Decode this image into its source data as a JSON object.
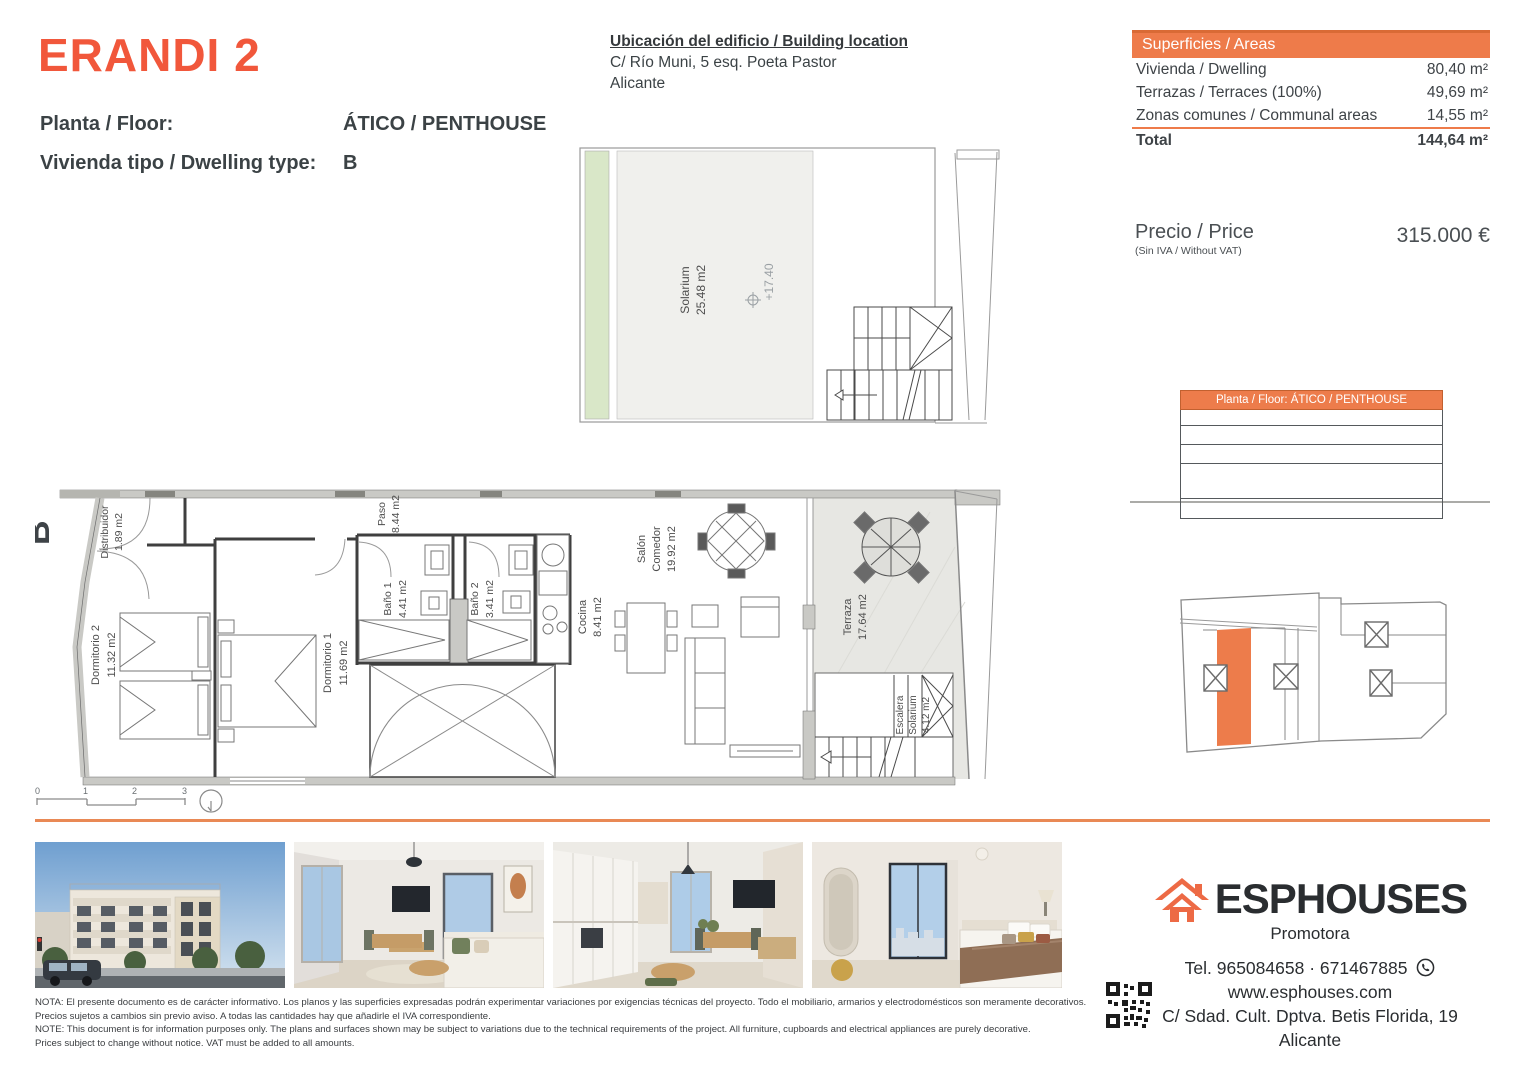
{
  "header": {
    "brand": "ERANDI 2",
    "floor_label": "Planta / Floor:",
    "floor_value": "ÁTICO / PENTHOUSE",
    "dwelling_label": "Vivienda tipo / Dwelling type:",
    "dwelling_value": "B"
  },
  "location": {
    "title": "Ubicación del edificio / Building location",
    "line1": "C/ Río Muni, 5 esq. Poeta Pastor",
    "line2": "Alicante"
  },
  "areas": {
    "title": "Superficies / Areas",
    "rows": [
      {
        "label": "Vivienda / Dwelling",
        "value": "80,40 m²"
      },
      {
        "label": "Terrazas / Terraces (100%)",
        "value": "49,69 m²"
      },
      {
        "label": "Zonas comunes / Communal areas",
        "value": "14,55 m²"
      }
    ],
    "total_label": "Total",
    "total_value": "144,64 m²"
  },
  "price": {
    "label": "Precio / Price",
    "note": "(Sin IVA / Without VAT)",
    "value": "315.000 €"
  },
  "key_plan": {
    "header": "Planta / Floor: ÁTICO / PENTHOUSE"
  },
  "plan": {
    "unit": "B",
    "solarium_name": "Solarium",
    "solarium_area": "25.48 m2",
    "level": "+17.40",
    "rooms": {
      "distribuidor": {
        "name": "Distribuidor",
        "area": "1.89 m2"
      },
      "dormitorio2": {
        "name": "Dormitorio 2",
        "area": "11.32 m2"
      },
      "dormitorio1": {
        "name": "Dormitorio 1",
        "area": "11.69 m2"
      },
      "paso": {
        "name": "Paso",
        "area": "8.44 m2"
      },
      "bano1": {
        "name": "Baño 1",
        "area": "4.41 m2"
      },
      "bano2": {
        "name": "Baño 2",
        "area": "3.41 m2"
      },
      "cocina": {
        "name": "Cocina",
        "area": "8.41 m2"
      },
      "salon": {
        "line1": "Salón",
        "line2": "Comedor",
        "area": "19.92 m2"
      },
      "terraza": {
        "name": "Terraza",
        "area": "17.64 m2"
      },
      "escalera": {
        "line1": "Escalera",
        "line2": "Solarium",
        "area": "4.12 m2"
      }
    }
  },
  "scale_bar": {
    "t0": "0",
    "t1": "1",
    "t2": "2",
    "t3": "3"
  },
  "contact": {
    "brand": "ESPHOUSES",
    "tagline": "Promotora",
    "phone": "Tel. 965084658 · 671467885",
    "web": "www.esphouses.com",
    "address": "C/ Sdad. Cult. Dptva. Betis Florida, 19",
    "city": "Alicante"
  },
  "disclaimer": {
    "line1": "NOTA: El presente documento es de carácter informativo. Los planos y las superficies expresadas podrán experimentar variaciones por exigencias técnicas del proyecto. Todo el mobiliario, armarios y electrodomésticos son meramente decorativos.",
    "line2": "Precios sujetos a cambios sin previo aviso. A todas las cantidades hay que añadirle el IVA correspondiente.",
    "line3": "NOTE: This document is for information purposes only. The plans and surfaces shown may be subject to variations due to the technical requirements of the project. All furniture, cupboards and electrical appliances are purely decorative.",
    "line4": "Prices subject to change without notice. VAT must be added to all amounts."
  },
  "colors": {
    "accent": "#EE7B4A",
    "brand_orange": "#F1573B",
    "divider": "#E98955",
    "text_dark": "#3E4347"
  }
}
